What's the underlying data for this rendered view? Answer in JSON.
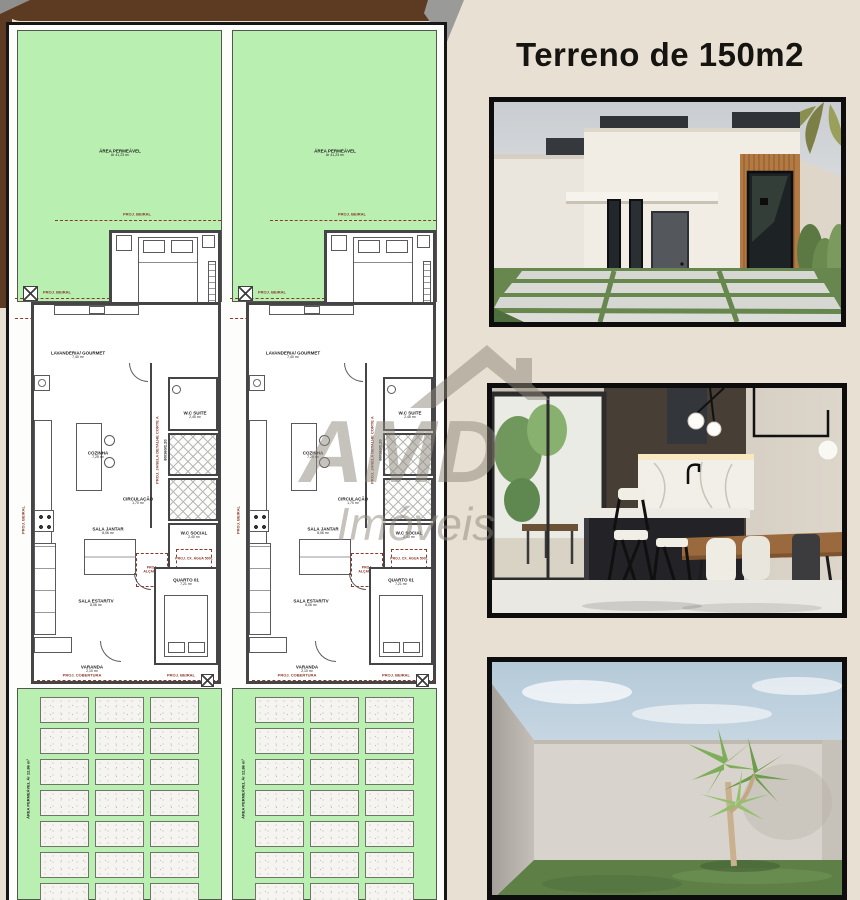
{
  "colors": {
    "beige": "#e8e1d3",
    "brown": "#5d3b22",
    "plan_green": "#b9f0b1",
    "frame_black": "#0d0d0d",
    "annotation_red": "#8a3a28",
    "watermark_gray": "#8e877b"
  },
  "heading": {
    "title": "Terreno de 150m2"
  },
  "plan": {
    "front_yard": {
      "line1": "ÁREA PERMEÁVEL",
      "line2": "Ár 41,23 m²"
    },
    "driveway": {
      "vertical_label": "ÁREA PERMEÁVEL  Ár 12,86 m²"
    },
    "rooms": {
      "suite": {
        "label": "SUITE",
        "area": "9,17 m²"
      },
      "lavanderia": {
        "label": "LAVANDERIA/ GOURMET",
        "area": "7,40 m²"
      },
      "cozinha": {
        "label": "COZINHA",
        "area": "7,25 m²"
      },
      "wc_suite": {
        "label": "W.C SUITE",
        "area": "2,45 m²"
      },
      "circulacao": {
        "label": "CIRCULAÇÃO",
        "area": "1,70 m²"
      },
      "wc_social": {
        "label": "W.C SOCIAL",
        "area": "2,40 m²"
      },
      "sala_jantar": {
        "label": "SALA JANTAR",
        "area": "8,06 m²"
      },
      "sala_estar": {
        "label": "SALA ESTAR/TV",
        "area": "8,06 m²"
      },
      "quarto": {
        "label": "QUARTO 01",
        "area": "7,21 m²"
      },
      "varanda": {
        "label": "VARANDA",
        "area": "2,10 m²"
      }
    },
    "annotations": {
      "proj_beiral": "PROJ. BEIRAL",
      "proj_cobertura": "PROJ. COBERTURA",
      "proj_alcapao": "PROJ. ALÇAPÃO",
      "proj_cx_agua": "PROJ. CX. ÁGUA 500L",
      "proj_janela": "PROJ. JANELA DETALHE CORTE A",
      "medida": "80/160/2.20"
    }
  },
  "watermark": {
    "letters": "AMD",
    "word": "Imóveis"
  }
}
